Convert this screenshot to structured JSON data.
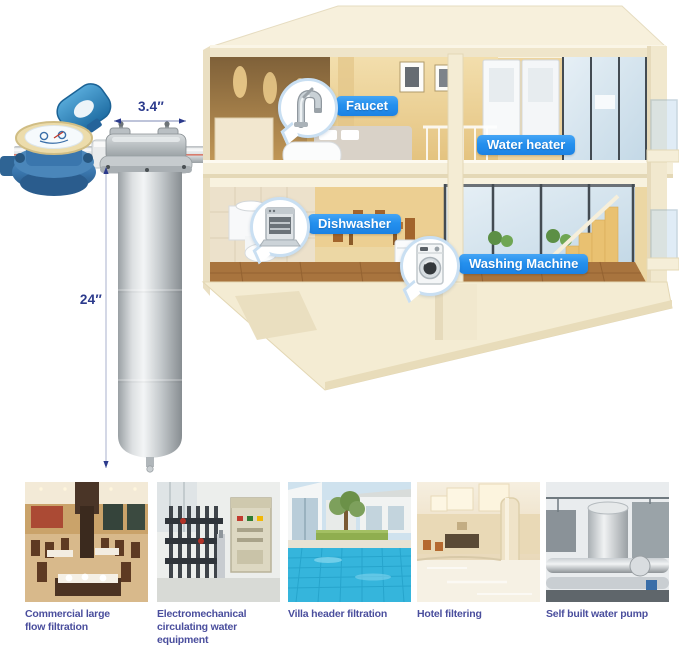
{
  "dimensions": {
    "width": "3.4″",
    "height": "24″"
  },
  "callouts": {
    "faucet": "Faucet",
    "water_heater": "Water heater",
    "dishwasher": "Dishwasher",
    "washing_machine": "Washing Machine"
  },
  "applications": [
    {
      "caption": "Commercial large flow filtration",
      "image": "restaurant-interior"
    },
    {
      "caption": "Electromechanical circulating water equipment",
      "image": "water-treatment-equipment"
    },
    {
      "caption": "Villa header filtration",
      "image": "villa-pool"
    },
    {
      "caption": "Hotel filtering",
      "image": "hotel-lobby"
    },
    {
      "caption": "Self built water pump",
      "image": "rooftop-water-pump"
    }
  ],
  "colors": {
    "accent_blue": "#2490ee",
    "dimension_text": "#2b3a8c",
    "caption_text": "#4a4e9d"
  }
}
